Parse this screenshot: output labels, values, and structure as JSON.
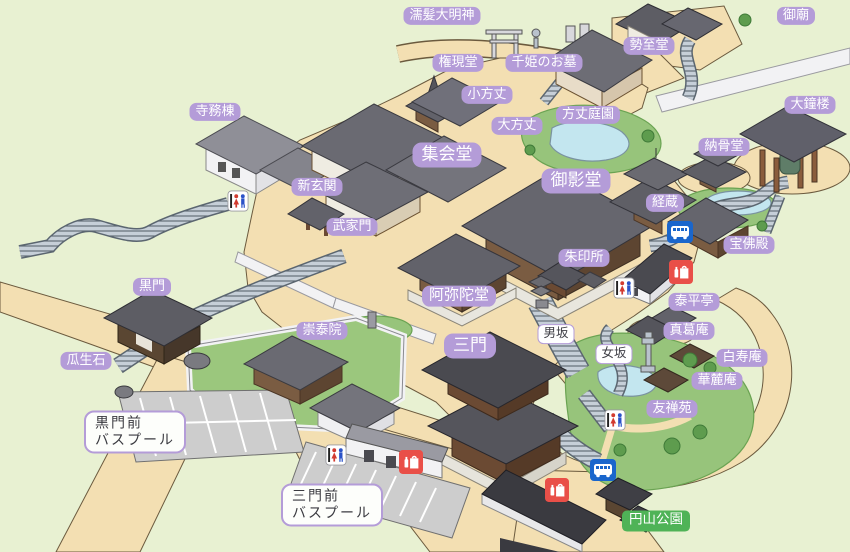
{
  "map": {
    "colors": {
      "background": "#e8f1d2",
      "path_beige": "#f3dfb2",
      "garden_green": "#97c47b",
      "pond_blue": "#c3e6ef",
      "label_purple": "#b49cd8",
      "label_text": "#ffffff",
      "park_green_label": "#4fb357",
      "bus_icon_blue": "#1a66cc",
      "shop_icon_red": "#e94f48",
      "restroom_red": "#d23b30",
      "restroom_blue": "#2a52c8"
    },
    "labels": [
      {
        "id": "nurekami-daimyojin",
        "text": "濡髪大明神",
        "x": 442,
        "y": 16,
        "style": "purple"
      },
      {
        "id": "gobyo",
        "text": "御廟",
        "x": 796,
        "y": 16,
        "style": "purple"
      },
      {
        "id": "gongendo",
        "text": "権現堂",
        "x": 458,
        "y": 63,
        "style": "purple"
      },
      {
        "id": "senhime-no-ohaka",
        "text": "千姫のお墓",
        "x": 544,
        "y": 63,
        "style": "purple"
      },
      {
        "id": "seishido",
        "text": "勢至堂",
        "x": 649,
        "y": 46,
        "style": "purple"
      },
      {
        "id": "ko-hojo",
        "text": "小方丈",
        "x": 487,
        "y": 95,
        "style": "purple"
      },
      {
        "id": "o-hojo",
        "text": "大方丈",
        "x": 517,
        "y": 126,
        "style": "purple"
      },
      {
        "id": "hojo-teien",
        "text": "方丈庭園",
        "x": 588,
        "y": 115,
        "style": "purple"
      },
      {
        "id": "daishoro",
        "text": "大鐘楼",
        "x": 810,
        "y": 105,
        "style": "purple"
      },
      {
        "id": "jimuto",
        "text": "寺務棟",
        "x": 215,
        "y": 112,
        "style": "purple"
      },
      {
        "id": "shukaido",
        "text": "集会堂",
        "x": 447,
        "y": 155,
        "style": "purple-lg"
      },
      {
        "id": "nokotsudo",
        "text": "納骨堂",
        "x": 724,
        "y": 147,
        "style": "purple"
      },
      {
        "id": "shin-genkan",
        "text": "新玄関",
        "x": 317,
        "y": 187,
        "style": "purple"
      },
      {
        "id": "mieido",
        "text": "御影堂",
        "x": 576,
        "y": 181,
        "style": "purple-lg"
      },
      {
        "id": "kyozo",
        "text": "経蔵",
        "x": 665,
        "y": 203,
        "style": "purple"
      },
      {
        "id": "bukemon",
        "text": "武家門",
        "x": 352,
        "y": 227,
        "style": "purple"
      },
      {
        "id": "hobutsuden",
        "text": "宝佛殿",
        "x": 749,
        "y": 245,
        "style": "purple"
      },
      {
        "id": "shuinsho",
        "text": "朱印所",
        "x": 584,
        "y": 258,
        "style": "purple"
      },
      {
        "id": "kuromon",
        "text": "黒門",
        "x": 152,
        "y": 287,
        "style": "purple"
      },
      {
        "id": "amidado",
        "text": "阿弥陀堂",
        "x": 459,
        "y": 296,
        "style": "purple-md"
      },
      {
        "id": "taiheitei",
        "text": "泰平亭",
        "x": 694,
        "y": 302,
        "style": "purple"
      },
      {
        "id": "sotaiin",
        "text": "崇泰院",
        "x": 322,
        "y": 331,
        "style": "purple"
      },
      {
        "id": "makuzuan",
        "text": "真葛庵",
        "x": 689,
        "y": 331,
        "style": "purple"
      },
      {
        "id": "uryuseki",
        "text": "瓜生石",
        "x": 86,
        "y": 361,
        "style": "purple"
      },
      {
        "id": "sanmon",
        "text": "三門",
        "x": 470,
        "y": 346,
        "style": "purple-lg"
      },
      {
        "id": "otokozaka",
        "text": "男坂",
        "x": 556,
        "y": 334,
        "style": "white-sm"
      },
      {
        "id": "onnazaka",
        "text": "女坂",
        "x": 614,
        "y": 354,
        "style": "white-sm"
      },
      {
        "id": "hakujuan",
        "text": "白寿庵",
        "x": 742,
        "y": 358,
        "style": "purple"
      },
      {
        "id": "karokuan",
        "text": "華麓庵",
        "x": 717,
        "y": 381,
        "style": "purple"
      },
      {
        "id": "yuzenen",
        "text": "友禅苑",
        "x": 672,
        "y": 409,
        "style": "purple"
      },
      {
        "id": "kuromon-mae-bus-pool",
        "lines": [
          "黒門前",
          "バスプール"
        ],
        "x": 135,
        "y": 432,
        "style": "white-box"
      },
      {
        "id": "sanmon-mae-bus-pool",
        "lines": [
          "三門前",
          "バスプール"
        ],
        "x": 332,
        "y": 505,
        "style": "white-box"
      },
      {
        "id": "maruyama-koen",
        "text": "円山公園",
        "x": 656,
        "y": 521,
        "style": "green"
      }
    ],
    "icons": [
      {
        "type": "restroom",
        "x": 238,
        "y": 201
      },
      {
        "type": "restroom",
        "x": 624,
        "y": 288
      },
      {
        "type": "restroom",
        "x": 615,
        "y": 420
      },
      {
        "type": "restroom",
        "x": 336,
        "y": 455
      },
      {
        "type": "bus-stop",
        "x": 680,
        "y": 232
      },
      {
        "type": "bus-stop",
        "x": 603,
        "y": 470
      },
      {
        "type": "shop",
        "x": 681,
        "y": 272
      },
      {
        "type": "shop",
        "x": 411,
        "y": 462
      },
      {
        "type": "shop",
        "x": 557,
        "y": 490
      }
    ]
  }
}
